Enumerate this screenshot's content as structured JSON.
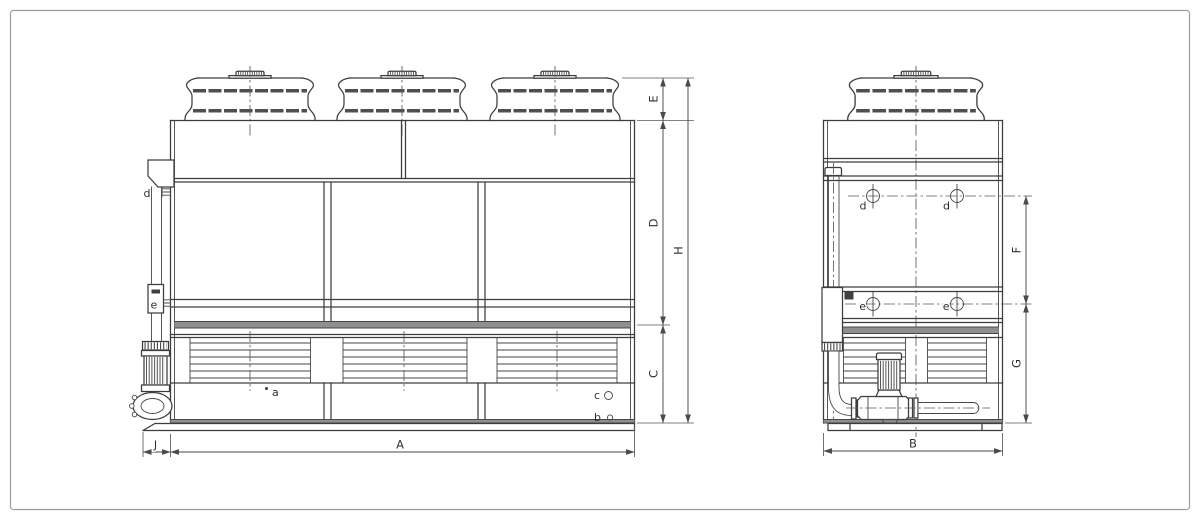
{
  "drawing": {
    "dimension_labels": {
      "A": "A",
      "B": "B",
      "C": "C",
      "D": "D",
      "E": "E",
      "F": "F",
      "G": "G",
      "H": "H",
      "J": "J"
    },
    "connection_labels": {
      "a": "a",
      "b": "b",
      "c": "c",
      "d": "d",
      "e": "e"
    },
    "colors": {
      "line": "#3d3d3d",
      "dimension": "#4a4a4a",
      "band_gray": "#8f8f8f",
      "dark_fill": "#3f3f3f",
      "border": "#9b9b9b",
      "background": "#ffffff"
    }
  }
}
